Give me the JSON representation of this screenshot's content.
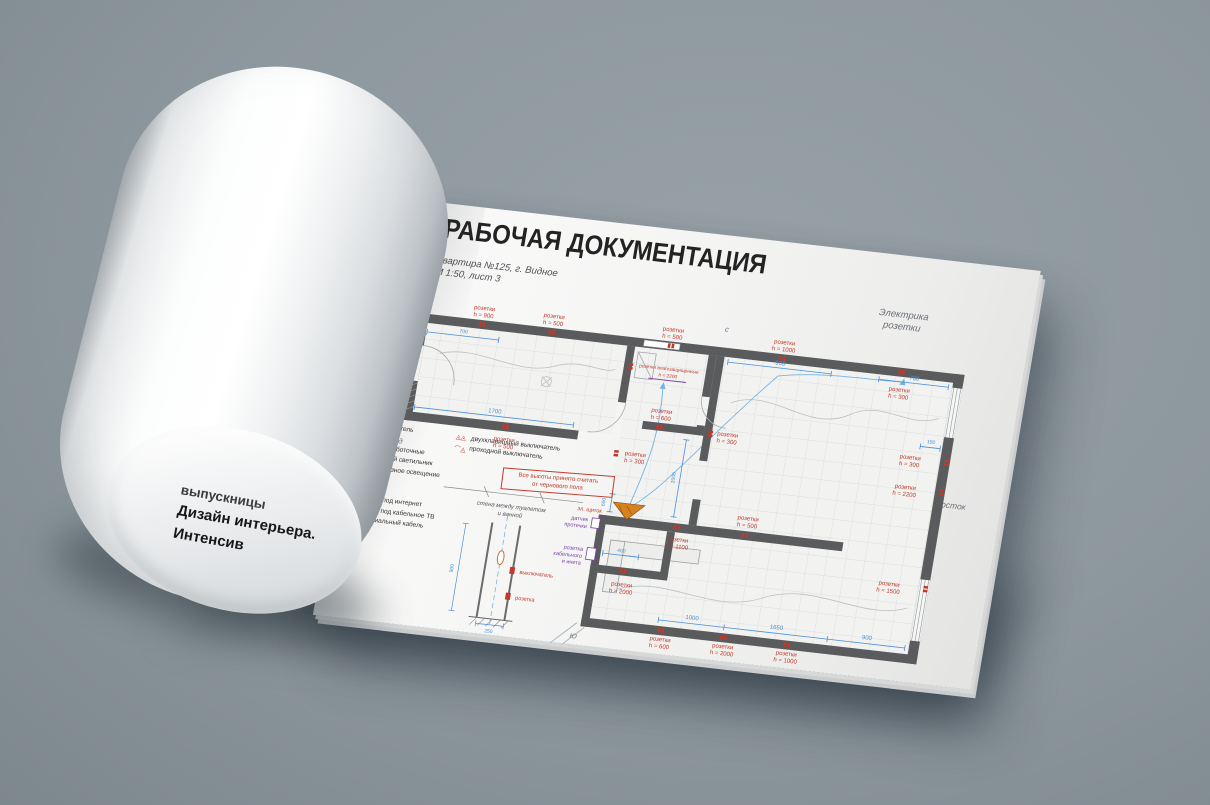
{
  "background": {
    "color": "#8d979e"
  },
  "flipped_page": {
    "line1": "выпускницы",
    "line2": "Дизайн интерьера.",
    "line3": "Интенсив"
  },
  "header": {
    "title": "01 / РАБОЧАЯ ДОКУМЕНТАЦИЯ",
    "subtitle1": "Квартира №125, г. Видное",
    "subtitle2": "М 1:50, лист 3",
    "sheet1": "Электрика",
    "sheet2": "розетки"
  },
  "plan": {
    "entrance": "вход",
    "compass": {
      "north": "с",
      "south": "Ю",
      "east": "восток"
    },
    "panel": "эл. щиток",
    "leak1": "датчик",
    "leak2": "протечки",
    "tv1": "розетка",
    "tv2": "кабельного",
    "tv3": "и инета",
    "sockets": [
      {
        "t": "розетки",
        "h": "h = 900"
      },
      {
        "t": "розетки",
        "h": "h = 500"
      },
      {
        "t": "розетки",
        "h": "h = 500"
      },
      {
        "t": "розетки",
        "h": "h = 1000"
      },
      {
        "t": "розетки",
        "h": "h = 300"
      },
      {
        "t": "розетки",
        "h": "h = 300"
      },
      {
        "t": "розетки",
        "h": "h = 2200"
      },
      {
        "t": "розетки",
        "h": "h = 1500"
      },
      {
        "t": "розетки",
        "h": "h = 500"
      },
      {
        "t": "розетки",
        "h": "h = 1100"
      },
      {
        "t": "розетки",
        "h": "h = 600"
      },
      {
        "t": "розетки",
        "h": "h = 2000"
      },
      {
        "t": "розетки",
        "h": "h = 1000"
      },
      {
        "t": "розетки влагозащищенные",
        "h": "h = 2200"
      },
      {
        "t": "розетки",
        "h": "h = 600"
      },
      {
        "t": "розетки",
        "h": "h = 300"
      },
      {
        "t": "розетки",
        "h": "h = 500"
      },
      {
        "t": "розетки",
        "h": "h = 2000"
      },
      {
        "t": "розетки",
        "h": "h = 300"
      }
    ],
    "dims": [
      "1700",
      "700",
      "900",
      "150",
      "1000",
      "1650",
      "900",
      "400",
      "600",
      "2000",
      "700"
    ]
  },
  "legend": {
    "col1": [
      {
        "glyph": "◬",
        "label": "выключатель"
      },
      {
        "glyph": "▲",
        "label": "розетка"
      },
      {
        "glyph": "⌒",
        "label": "сети слаботочные"
      },
      {
        "glyph": "✚",
        "label": "точечный светильник"
      },
      {
        "glyph": "▬",
        "label": "закарнизное освещение"
      },
      {
        "glyph": "✳",
        "label": "люстра"
      },
      {
        "glyph": "◮",
        "label": "бра"
      },
      {
        "glyph": "⊡",
        "label": "вывод под интернет"
      },
      {
        "glyph": "⊠",
        "label": "вывод под кабельное ТВ"
      },
      {
        "glyph": "—·—",
        "label": "коаксиальный кабель"
      }
    ],
    "col2": [
      {
        "glyph": "◬◬",
        "label": "двухклавишный выключатель"
      },
      {
        "glyph": "⌒◬",
        "label": "проходной выключатель"
      }
    ],
    "note1": "Все высоты принято считать",
    "note2": "от чернового пола"
  },
  "detail": {
    "cap1": "стена между туалетом",
    "cap2": "и ванной",
    "switch_label": "выключатель",
    "socket_label": "розетка",
    "dim_a": "900",
    "dim_b": "250"
  },
  "colors": {
    "socket_red": "#c2392b",
    "dimension_blue": "#4a90d9",
    "wall_gray": "#5a5b5d",
    "purple": "#7d3fa8",
    "panel_orange": "#d8821f"
  }
}
